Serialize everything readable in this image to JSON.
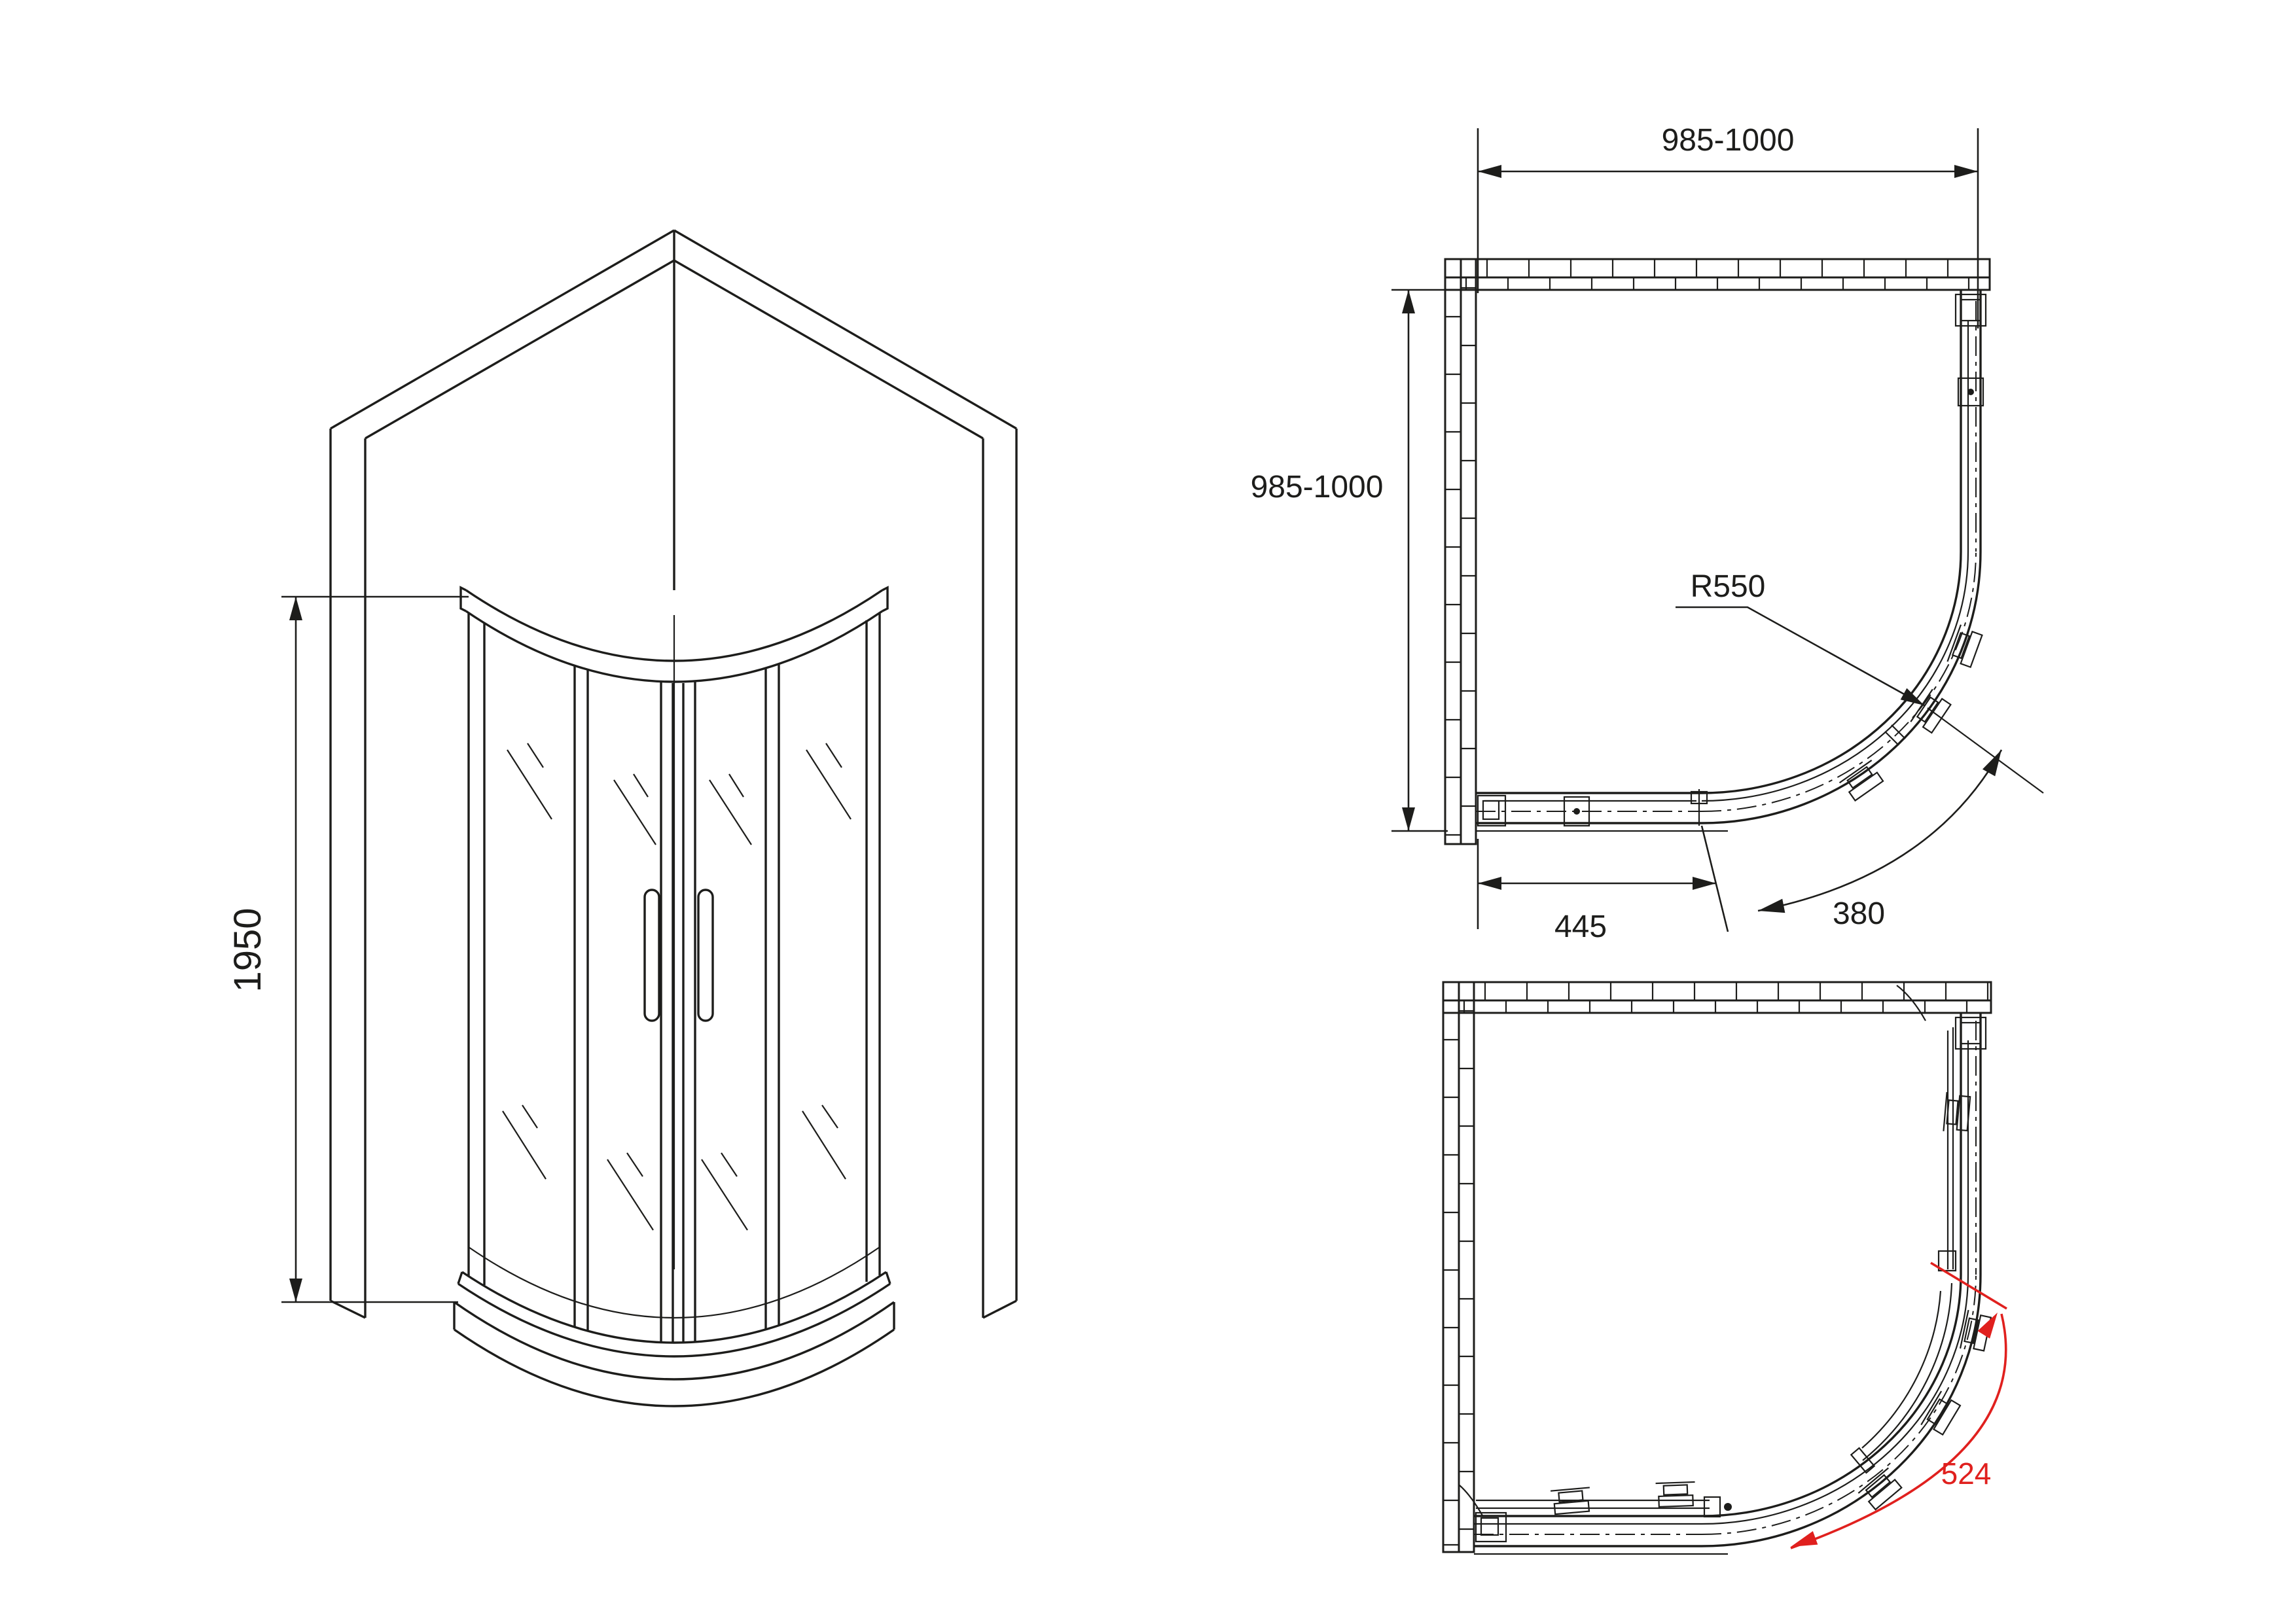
{
  "document": {
    "type": "technical-drawing",
    "subject": "quadrant sliding-door shower enclosure, three orthographic/isometric views"
  },
  "labels": {
    "iso_height": "1950",
    "plan_width": "985-1000",
    "plan_depth": "985-1000",
    "radius": "R550",
    "side_panel_width": "445",
    "door_opening": "380",
    "entry_width": "524"
  },
  "colors": {
    "line": "#1d1d1b",
    "accent_red": "#e0201e",
    "background": "#ffffff"
  }
}
